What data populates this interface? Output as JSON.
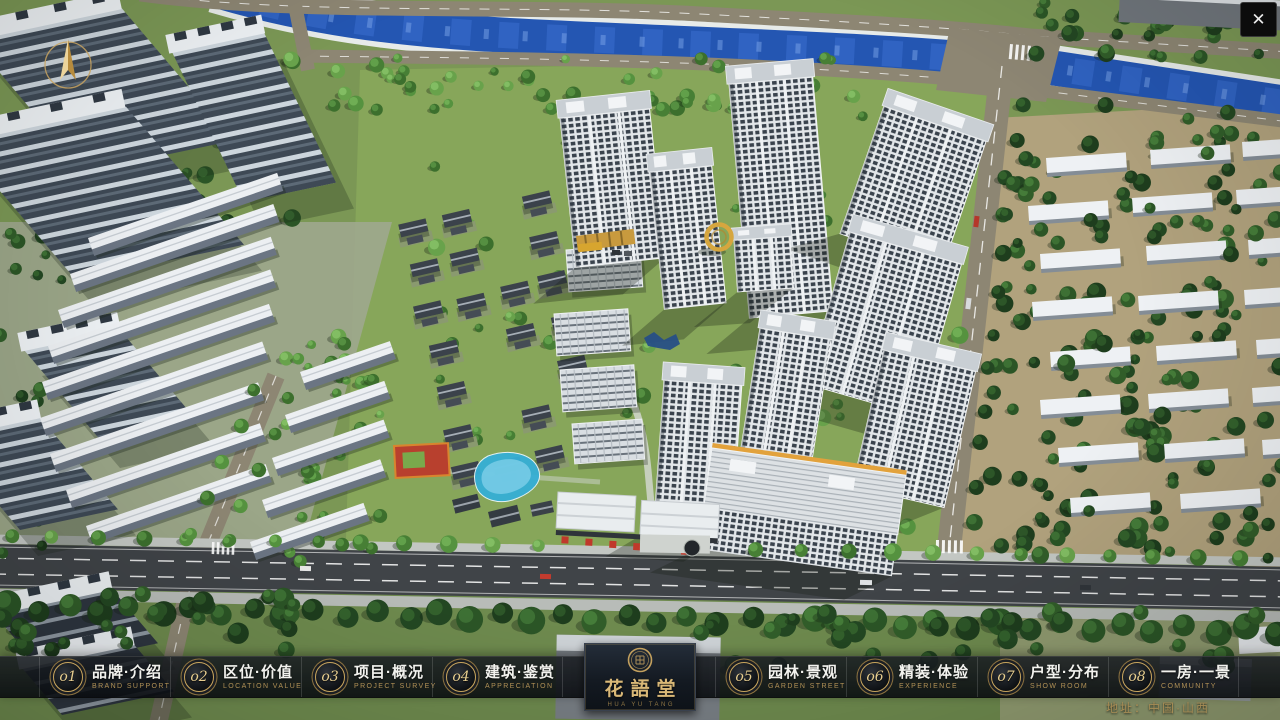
{
  "window": {
    "close_glyph": "✕"
  },
  "navbar": {
    "items": [
      {
        "num": "o1",
        "zh": "品牌·介绍",
        "en": "BRAND SUPPORT"
      },
      {
        "num": "o2",
        "zh": "区位·价值",
        "en": "LOCATION VALUE"
      },
      {
        "num": "o3",
        "zh": "项目·概况",
        "en": "PROJECT SURVEY"
      },
      {
        "num": "o4",
        "zh": "建筑·鉴赏",
        "en": "APPRECIATION"
      },
      {
        "num": "o5",
        "zh": "园林·景观",
        "en": "GARDEN STREET"
      },
      {
        "num": "o6",
        "zh": "精装·体验",
        "en": "EXPERIENCE"
      },
      {
        "num": "o7",
        "zh": "户型·分布",
        "en": "SHOW ROOM"
      },
      {
        "num": "o8",
        "zh": "一房·一景",
        "en": "COMMUNITY"
      }
    ]
  },
  "logo": {
    "title": "花語堂",
    "subtitle": "HUA YU TANG"
  },
  "footer": {
    "address": "地址：中国·山西"
  },
  "colors": {
    "gold": "#c9a35f",
    "bar": "rgba(12,16,20,0.85)",
    "river": "#2456b2"
  }
}
